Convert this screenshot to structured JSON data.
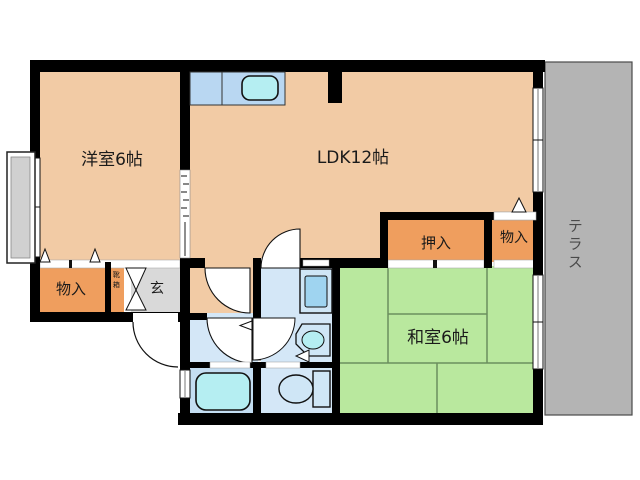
{
  "plan": {
    "type": "apartment-floor-plan",
    "rooms": {
      "western_room_label": "洋室6帖",
      "ldk_label": "LDK12帖",
      "japanese_room_label": "和室6帖",
      "closet_oshiire_label": "押入",
      "storage_right_label": "物入",
      "storage_left_label": "物入",
      "entrance_label": "玄",
      "shoe_cabinet_label": "靴箱",
      "terrace_label": "テラス"
    },
    "colors": {
      "wall": "#000000",
      "room_peach": "#f2cba5",
      "closet_orange": "#ef9e5e",
      "tatami_green": "#b9e89e",
      "terrace_gray": "#b4b4b4",
      "entrance_gray": "#d9d9d9",
      "water_blue": "#d4e7f7",
      "bath_blue": "#c4def2",
      "fixture_cyan": "#b5eef2",
      "counter_blue": "#b9d7f2"
    }
  }
}
